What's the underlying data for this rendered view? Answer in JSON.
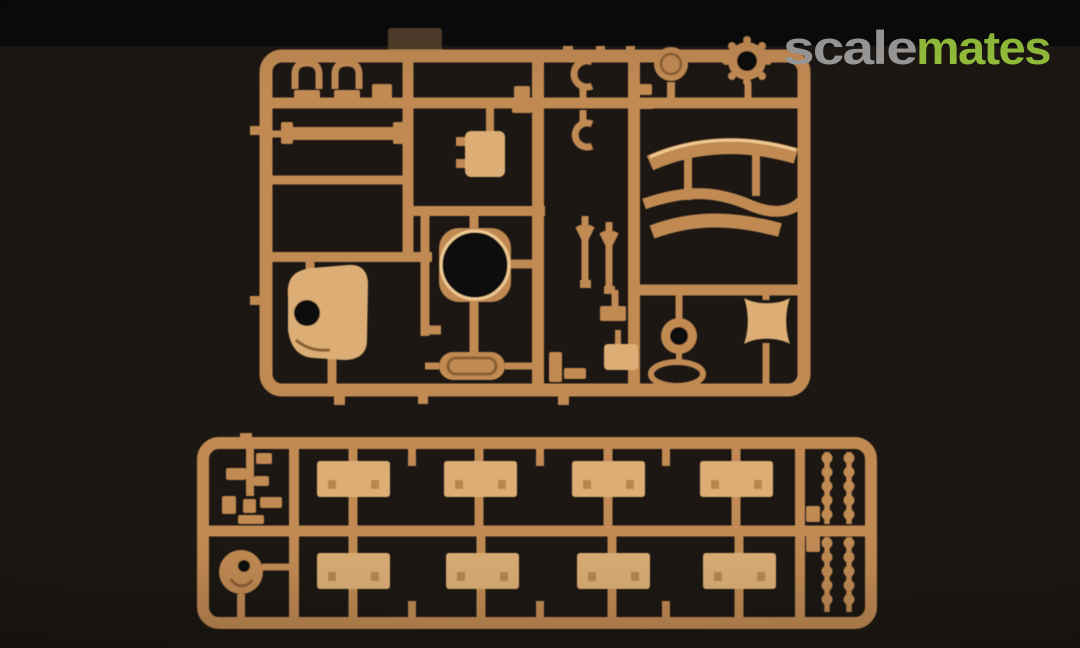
{
  "watermark": {
    "scale_text": "scale",
    "mates_text": "mates",
    "scale_color": "#9b9b9b",
    "mates_color": "#95c13c"
  },
  "photo": {
    "alt": "Two tan injection-molded plastic model-kit sprues photographed on a black backdrop",
    "palette": {
      "bg_strip": "#0b0b0b",
      "bg_main": "#1c1712",
      "sprue_base": "#c18a52",
      "sprue_light": "#dcae74",
      "sprue_highlight": "#eec992",
      "sprue_shadow": "#8a5e33",
      "sprue_bolt": "#b8874d",
      "tab_brown": "#4f3d29",
      "hole_dark": "#0f0c09"
    }
  }
}
